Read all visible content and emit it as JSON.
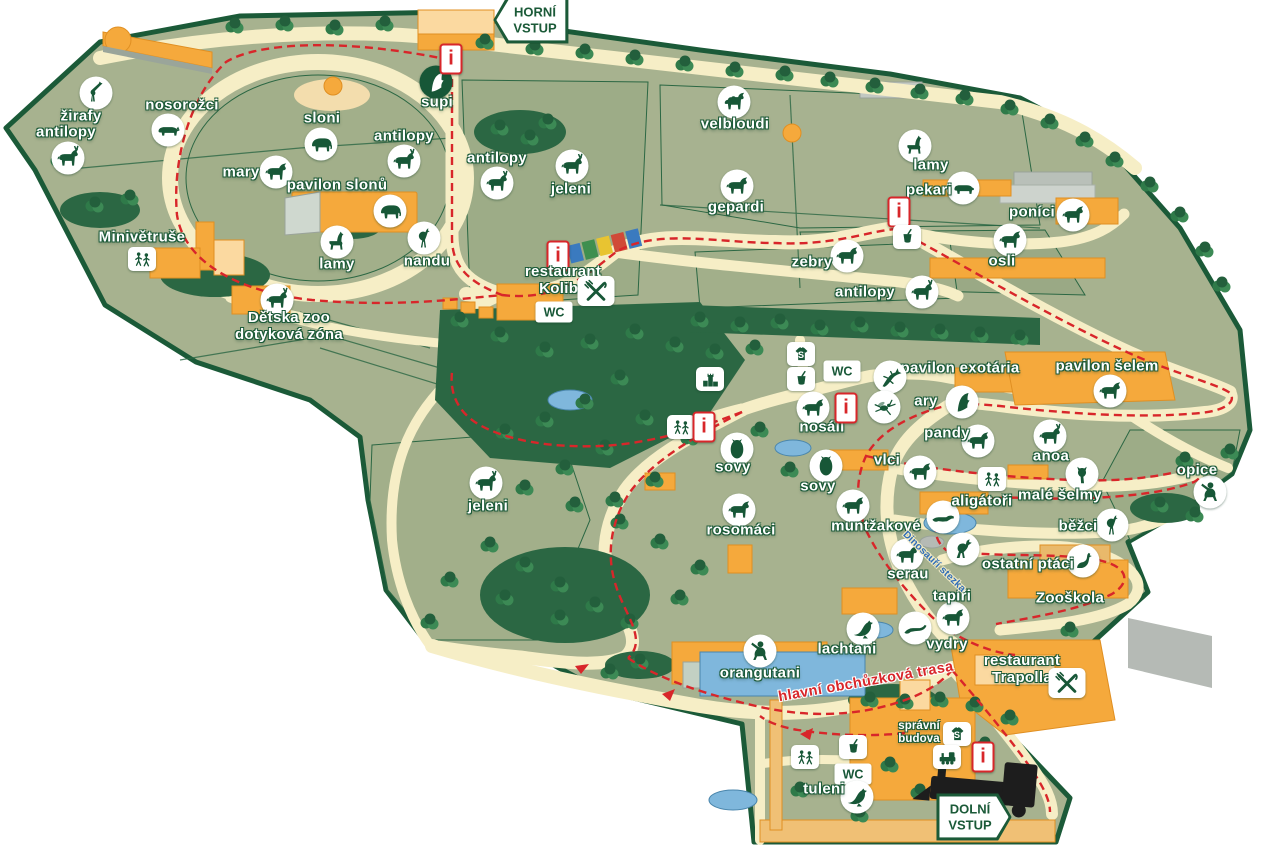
{
  "map": {
    "title": "zoo-areal-mapa",
    "colors": {
      "outline": "#1b5a38",
      "field": "#a7b28f",
      "path": "#f6eec6",
      "route": "#d8262a",
      "building": "#f5a93c",
      "water": "#7fb7dc",
      "label": "#ffffff",
      "dino_trail": "#2f6db8"
    },
    "signs": [
      {
        "id": "horni-vstup",
        "lines": [
          "HORNÍ",
          "VSTUP"
        ],
        "x": 531,
        "y": 20,
        "dir": "left"
      },
      {
        "id": "dolni-vstup",
        "lines": [
          "DOLNÍ",
          "VSTUP"
        ],
        "x": 974,
        "y": 817,
        "dir": "right"
      }
    ],
    "markers": [
      {
        "id": "zirafy",
        "lines": [
          "žirafy"
        ],
        "lx": 81,
        "ly": 117,
        "glyph": "giraffe",
        "ix": 96,
        "iy": 93
      },
      {
        "id": "antilopy-1",
        "lines": [
          "antilopy"
        ],
        "lx": 66,
        "ly": 133,
        "glyph": "horned",
        "ix": 68,
        "iy": 158
      },
      {
        "id": "nosorozci",
        "lines": [
          "nosorožci"
        ],
        "lx": 182,
        "ly": 106,
        "glyph": "rhino",
        "ix": 168,
        "iy": 130
      },
      {
        "id": "sloni",
        "lines": [
          "sloni"
        ],
        "lx": 322,
        "ly": 119,
        "glyph": "elephant",
        "ix": 321,
        "iy": 144
      },
      {
        "id": "mary",
        "lines": [
          "mary"
        ],
        "lx": 241,
        "ly": 173,
        "glyph": "quadruped",
        "ix": 276,
        "iy": 172
      },
      {
        "id": "pavilon-slonu",
        "lines": [
          "pavilon slonů"
        ],
        "lx": 337,
        "ly": 186,
        "glyph": "elephant",
        "ix": 390,
        "iy": 211
      },
      {
        "id": "minivetruse",
        "lines": [
          "Minivětruše"
        ],
        "lx": 142,
        "ly": 238
      },
      {
        "id": "playground-minivetruse",
        "glyph": "playground",
        "shape": "square",
        "ix": 142,
        "iy": 259
      },
      {
        "id": "lamy-1",
        "lines": [
          "lamy"
        ],
        "lx": 337,
        "ly": 265,
        "glyph": "llama",
        "ix": 337,
        "iy": 242
      },
      {
        "id": "nandu",
        "lines": [
          "nandu"
        ],
        "lx": 427,
        "ly": 262,
        "glyph": "ratite",
        "ix": 424,
        "iy": 238
      },
      {
        "id": "supi",
        "lines": [
          "supi"
        ],
        "lx": 437,
        "ly": 103,
        "glyph": "bird",
        "ix": 436,
        "iy": 82,
        "inv": true
      },
      {
        "id": "antilopy-2",
        "lines": [
          "antilopy"
        ],
        "lx": 404,
        "ly": 137,
        "glyph": "horned",
        "ix": 404,
        "iy": 161
      },
      {
        "id": "antilopy-3",
        "lines": [
          "antilopy"
        ],
        "lx": 497,
        "ly": 159,
        "glyph": "horned",
        "ix": 497,
        "iy": 183
      },
      {
        "id": "jeleni-1",
        "lines": [
          "jeleni"
        ],
        "lx": 571,
        "ly": 190,
        "glyph": "horned",
        "ix": 572,
        "iy": 166
      },
      {
        "id": "velbloudi",
        "lines": [
          "velbloudi"
        ],
        "lx": 735,
        "ly": 125,
        "glyph": "camel",
        "ix": 734,
        "iy": 102
      },
      {
        "id": "gepardi",
        "lines": [
          "gepardi"
        ],
        "lx": 736,
        "ly": 208,
        "glyph": "quadruped",
        "ix": 737,
        "iy": 186
      },
      {
        "id": "lamy-2",
        "lines": [
          "lamy"
        ],
        "lx": 931,
        "ly": 166,
        "glyph": "llama",
        "ix": 915,
        "iy": 146
      },
      {
        "id": "pekari",
        "lines": [
          "pekari"
        ],
        "lx": 929,
        "ly": 191,
        "glyph": "pig",
        "ix": 963,
        "iy": 188
      },
      {
        "id": "info-pekari",
        "type": "info",
        "text": "i",
        "ix": 899,
        "iy": 212
      },
      {
        "id": "cup-pekari",
        "glyph": "cup",
        "shape": "square",
        "ix": 907,
        "iy": 237
      },
      {
        "id": "ponici",
        "lines": [
          "poníci"
        ],
        "lx": 1032,
        "ly": 213,
        "glyph": "quadruped",
        "ix": 1073,
        "iy": 215
      },
      {
        "id": "osli",
        "lines": [
          "osli"
        ],
        "lx": 1002,
        "ly": 262,
        "glyph": "quadruped",
        "ix": 1010,
        "iy": 240
      },
      {
        "id": "zebry",
        "lines": [
          "zebry"
        ],
        "lx": 812,
        "ly": 263,
        "glyph": "quadruped",
        "ix": 847,
        "iy": 256
      },
      {
        "id": "antilopy-4",
        "lines": [
          "antilopy"
        ],
        "lx": 865,
        "ly": 293,
        "glyph": "horned",
        "ix": 922,
        "iy": 292
      },
      {
        "id": "info-horni",
        "type": "info",
        "text": "i",
        "ix": 451,
        "iy": 59
      },
      {
        "id": "info-koliba",
        "type": "info",
        "text": "i",
        "ix": 558,
        "iy": 256
      },
      {
        "id": "restaurant-koliba",
        "lines": [
          "restaurant",
          "Koliba"
        ],
        "lx": 563,
        "ly": 281
      },
      {
        "id": "cutlery-koliba",
        "glyph": "cutlery",
        "shape": "square",
        "big": true,
        "ix": 596,
        "iy": 291
      },
      {
        "id": "wc-koliba",
        "type": "wc",
        "text": "WC",
        "ix": 554,
        "iy": 312
      },
      {
        "id": "detska-zoo",
        "lines": [
          "Dětska zoo",
          "dotyková zóna"
        ],
        "lx": 289,
        "ly": 327,
        "glyph": "horned",
        "ix": 277,
        "iy": 300
      },
      {
        "id": "jeleni-2",
        "lines": [
          "jeleni"
        ],
        "lx": 488,
        "ly": 507,
        "glyph": "horned",
        "ix": 486,
        "iy": 483
      },
      {
        "id": "shop-horni",
        "glyph": "shirt",
        "shape": "square",
        "ix": 801,
        "iy": 354,
        "text": "S"
      },
      {
        "id": "cup-center",
        "glyph": "cup",
        "shape": "square",
        "ix": 801,
        "iy": 379
      },
      {
        "id": "wc-center",
        "type": "wc",
        "text": "WC",
        "ix": 842,
        "iy": 371
      },
      {
        "id": "tower",
        "glyph": "castle",
        "shape": "square",
        "ix": 710,
        "iy": 379
      },
      {
        "id": "playground-center",
        "glyph": "playground",
        "shape": "square",
        "ix": 681,
        "iy": 427
      },
      {
        "id": "info-center",
        "type": "info",
        "text": "i",
        "ix": 704,
        "iy": 427
      },
      {
        "id": "nosali",
        "lines": [
          "nosáli"
        ],
        "lx": 822,
        "ly": 428,
        "glyph": "quadruped",
        "ix": 813,
        "iy": 408
      },
      {
        "id": "info-nosali",
        "type": "info",
        "text": "i",
        "ix": 846,
        "iy": 408
      },
      {
        "id": "pavilon-exotaria",
        "lines": [
          "pavilon exotária"
        ],
        "lx": 960,
        "ly": 369
      },
      {
        "id": "lizard-exotaria",
        "glyph": "lizard",
        "ix": 890,
        "iy": 377
      },
      {
        "id": "insect",
        "glyph": "insect",
        "ix": 884,
        "iy": 407
      },
      {
        "id": "ary",
        "lines": [
          "ary"
        ],
        "lx": 926,
        "ly": 402,
        "glyph": "bird",
        "ix": 962,
        "iy": 402
      },
      {
        "id": "pavilon-selem",
        "lines": [
          "pavilon šelem"
        ],
        "lx": 1107,
        "ly": 367,
        "glyph": "quadruped",
        "ix": 1110,
        "iy": 391
      },
      {
        "id": "pandy",
        "lines": [
          "pandy"
        ],
        "lx": 947,
        "ly": 434,
        "glyph": "quadruped",
        "ix": 978,
        "iy": 441
      },
      {
        "id": "anoa",
        "lines": [
          "anoa"
        ],
        "lx": 1051,
        "ly": 457,
        "glyph": "horned",
        "ix": 1050,
        "iy": 436
      },
      {
        "id": "vlci",
        "lines": [
          "vlci"
        ],
        "lx": 887,
        "ly": 461,
        "glyph": "quadruped",
        "ix": 920,
        "iy": 472
      },
      {
        "id": "male-selmy",
        "lines": [
          "malé šelmy"
        ],
        "lx": 1060,
        "ly": 496,
        "glyph": "cat",
        "ix": 1082,
        "iy": 474
      },
      {
        "id": "playground-selmy",
        "glyph": "playground",
        "shape": "square",
        "ix": 992,
        "iy": 479
      },
      {
        "id": "aligatori",
        "lines": [
          "aligátoři"
        ],
        "lx": 982,
        "ly": 502,
        "glyph": "gator",
        "ix": 943,
        "iy": 517
      },
      {
        "id": "opice",
        "lines": [
          "opice"
        ],
        "lx": 1197,
        "ly": 471,
        "glyph": "monkey",
        "ix": 1210,
        "iy": 492
      },
      {
        "id": "bezci",
        "lines": [
          "běžci"
        ],
        "lx": 1078,
        "ly": 527,
        "glyph": "ratite",
        "ix": 1112,
        "iy": 525
      },
      {
        "id": "muntzakove",
        "lines": [
          "muntžakové"
        ],
        "lx": 876,
        "ly": 527,
        "glyph": "quadruped",
        "ix": 853,
        "iy": 506
      },
      {
        "id": "rosomaci",
        "lines": [
          "rosomáci"
        ],
        "lx": 741,
        "ly": 531,
        "glyph": "quadruped",
        "ix": 739,
        "iy": 510
      },
      {
        "id": "sovy-1",
        "lines": [
          "sovy"
        ],
        "lx": 733,
        "ly": 468,
        "glyph": "owl",
        "ix": 737,
        "iy": 449
      },
      {
        "id": "sovy-2",
        "lines": [
          "sovy"
        ],
        "lx": 818,
        "ly": 487,
        "glyph": "owl",
        "ix": 826,
        "iy": 466
      },
      {
        "id": "serau",
        "lines": [
          "serau"
        ],
        "lx": 908,
        "ly": 575,
        "glyph": "horned",
        "ix": 907,
        "iy": 555
      },
      {
        "id": "dino",
        "glyph": "dino",
        "ix": 963,
        "iy": 549
      },
      {
        "id": "ostatni-ptaci",
        "lines": [
          "ostatní ptáci"
        ],
        "lx": 1028,
        "ly": 565,
        "glyph": "goose",
        "ix": 1083,
        "iy": 561
      },
      {
        "id": "zooskola",
        "lines": [
          "Zooškola"
        ],
        "lx": 1070,
        "ly": 599
      },
      {
        "id": "tapiri",
        "lines": [
          "tapíři"
        ],
        "lx": 952,
        "ly": 597,
        "glyph": "quadruped",
        "ix": 953,
        "iy": 618
      },
      {
        "id": "vydry",
        "lines": [
          "vydry"
        ],
        "lx": 947,
        "ly": 645,
        "glyph": "otter",
        "ix": 915,
        "iy": 628
      },
      {
        "id": "lachtani",
        "lines": [
          "lachtani"
        ],
        "lx": 847,
        "ly": 650,
        "glyph": "seal",
        "ix": 863,
        "iy": 629
      },
      {
        "id": "orangutani",
        "lines": [
          "orangutani"
        ],
        "lx": 760,
        "ly": 674,
        "glyph": "monkey",
        "ix": 760,
        "iy": 651
      },
      {
        "id": "restaurant-trapolla",
        "lines": [
          "restaurant",
          "Trapolla"
        ],
        "lx": 1022,
        "ly": 670
      },
      {
        "id": "cutlery-trapolla",
        "glyph": "cutlery",
        "shape": "square",
        "big": true,
        "ix": 1067,
        "iy": 683
      },
      {
        "id": "spravni-budova",
        "lines": [
          "správní",
          "budova"
        ],
        "lx": 919,
        "ly": 733,
        "size": "small"
      },
      {
        "id": "shop-dolni",
        "glyph": "shirt",
        "shape": "square",
        "ix": 957,
        "iy": 734,
        "text": "S"
      },
      {
        "id": "train",
        "glyph": "train",
        "shape": "square",
        "ix": 947,
        "iy": 757
      },
      {
        "id": "info-dolni",
        "type": "info",
        "text": "i",
        "ix": 983,
        "iy": 757
      },
      {
        "id": "playground-dolni",
        "glyph": "playground",
        "shape": "square",
        "ix": 805,
        "iy": 757
      },
      {
        "id": "cup-dolni",
        "glyph": "cup",
        "shape": "square",
        "ix": 853,
        "iy": 747
      },
      {
        "id": "wc-dolni",
        "type": "wc",
        "text": "WC",
        "ix": 853,
        "iy": 774
      },
      {
        "id": "tuleni",
        "lines": [
          "tuleni"
        ],
        "lx": 824,
        "ly": 790,
        "glyph": "seal",
        "ix": 857,
        "iy": 797
      },
      {
        "id": "trasa-label",
        "lines": [
          "hlavní obchůzková trasa"
        ],
        "lx": 866,
        "ly": 682,
        "cls": "route-red",
        "rotate": -10
      },
      {
        "id": "dino-stezka-label",
        "lines": [
          "Dinosauří stezka"
        ],
        "lx": 934,
        "ly": 562,
        "cls": "route-blue",
        "rotate": 44
      }
    ]
  }
}
